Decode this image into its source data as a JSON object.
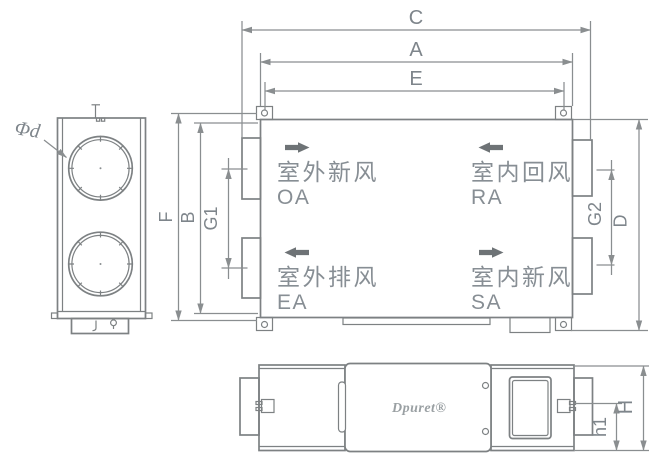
{
  "drawing": {
    "dims": {
      "c": "C",
      "a": "A",
      "e": "E",
      "f": "F",
      "b": "B",
      "g1": "G1",
      "g2": "G2",
      "d": "D",
      "h1": "h1",
      "h": "H",
      "diameter": "Φd"
    },
    "ports": {
      "oa": {
        "cn": "室外新风",
        "code": "OA",
        "direction": "right"
      },
      "ra": {
        "cn": "室内回风",
        "code": "RA",
        "direction": "left"
      },
      "ea": {
        "cn": "室外排风",
        "code": "EA",
        "direction": "left"
      },
      "sa": {
        "cn": "室内新风",
        "code": "SA",
        "direction": "right"
      }
    },
    "logo": "Dpuret®",
    "colors": {
      "line": "#7d8183",
      "dimension": "#8a8e90",
      "text": "#7e858b",
      "flow_arrow": "#6e7376",
      "logo": "#9aa0a3",
      "background": "#ffffff"
    }
  }
}
